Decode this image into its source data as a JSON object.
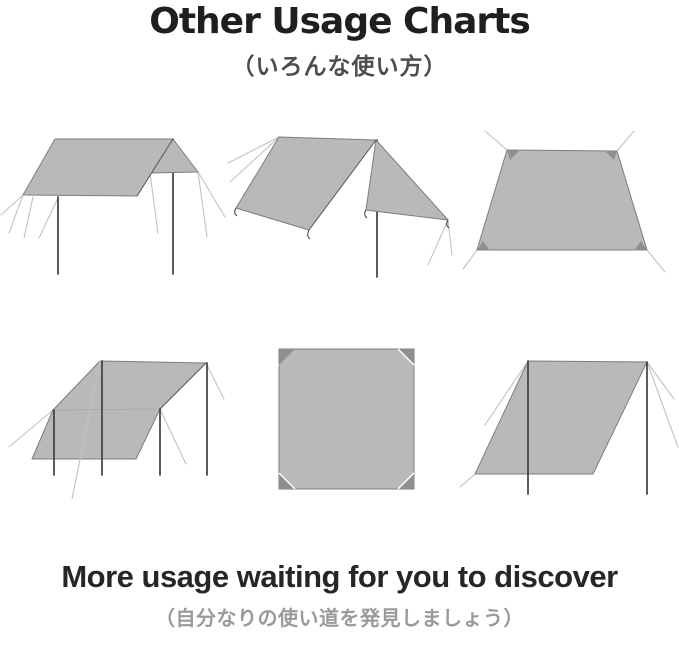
{
  "header": {
    "title": "Other Usage Charts",
    "subtitle_jp": "（いろんな使い方）"
  },
  "footer": {
    "heading": "More usage waiting for you to discover",
    "subheading_jp": "（自分なりの使い道を発見しましょう）"
  },
  "diagrams": [
    {
      "name": "flat-canopy-tarp-with-two-poles-diagram"
    },
    {
      "name": "a-frame-tarp-shelter-diagram"
    },
    {
      "name": "ground-sheet-trapezoid-tarp-diagram"
    },
    {
      "name": "awning-lean-to-four-pole-tarp-diagram"
    },
    {
      "name": "square-tarp-top-view-diagram"
    },
    {
      "name": "slanted-windbreak-tarp-diagram"
    }
  ],
  "colors": {
    "bg": "#ffffff",
    "tarp_fill": "#b9b9b9",
    "tarp_edge": "#7d7d7d",
    "fold_edge": "#5f5f5f",
    "pole": "#3f3f3f",
    "guy_line": "#c2c2c2",
    "corner_mark": "#8f8f8f",
    "title": "#1f1f1f",
    "subtitle": "#4d4d4d",
    "footer_heading": "#262626",
    "footer_sub": "#9a9a9a"
  }
}
